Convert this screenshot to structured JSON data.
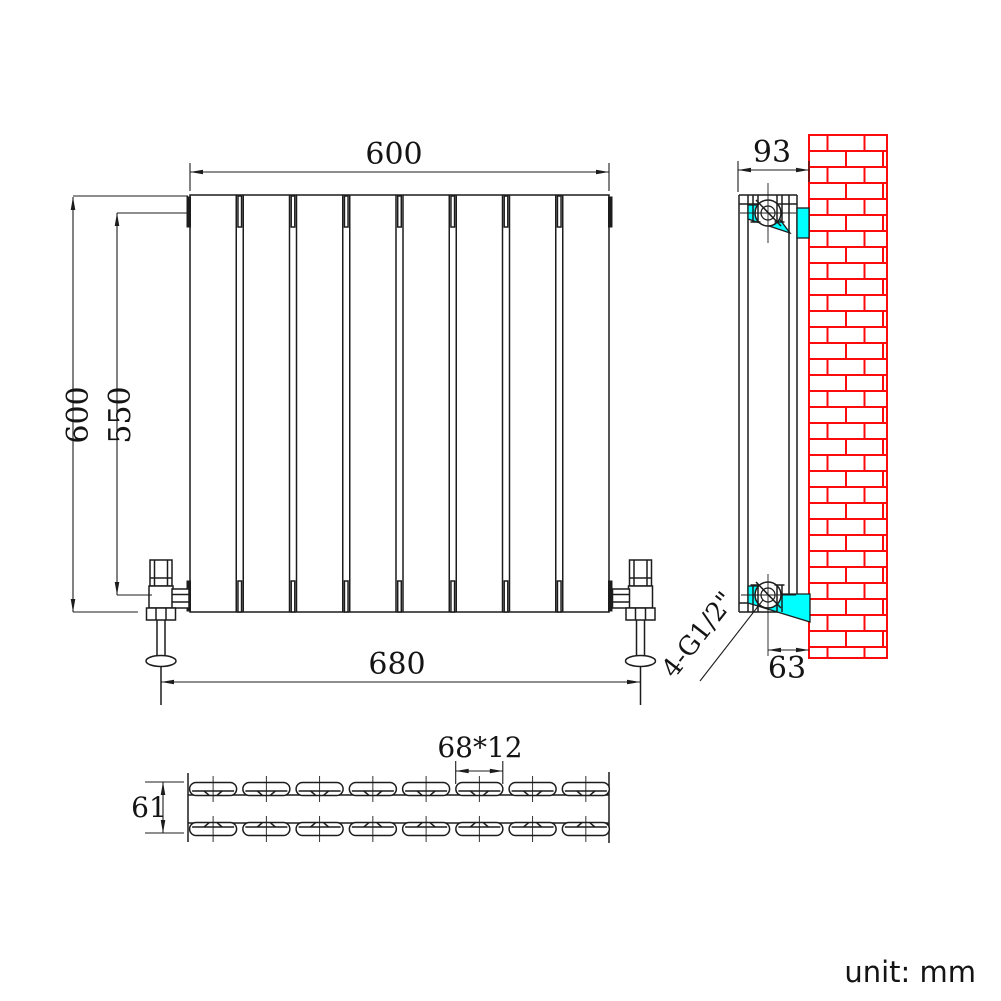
{
  "title": "Double panel radiator technical drawing",
  "unit_note": "unit: mm",
  "front_view": {
    "width": "600",
    "height": "600",
    "inner_height": "550",
    "valve_spacing": "680",
    "panel_count": 8
  },
  "side_view": {
    "depth": "93",
    "bottom_wall_offset": "63",
    "connection_label": "4-G1/2\""
  },
  "section_view": {
    "tube_size": "68*12",
    "depth": "61",
    "tube_count_per_row": 8,
    "rows": 2
  },
  "colors": {
    "line": "#1c1c1c",
    "bracket_cyan": "#00ffff",
    "wall_red": "#fb0b0b"
  }
}
